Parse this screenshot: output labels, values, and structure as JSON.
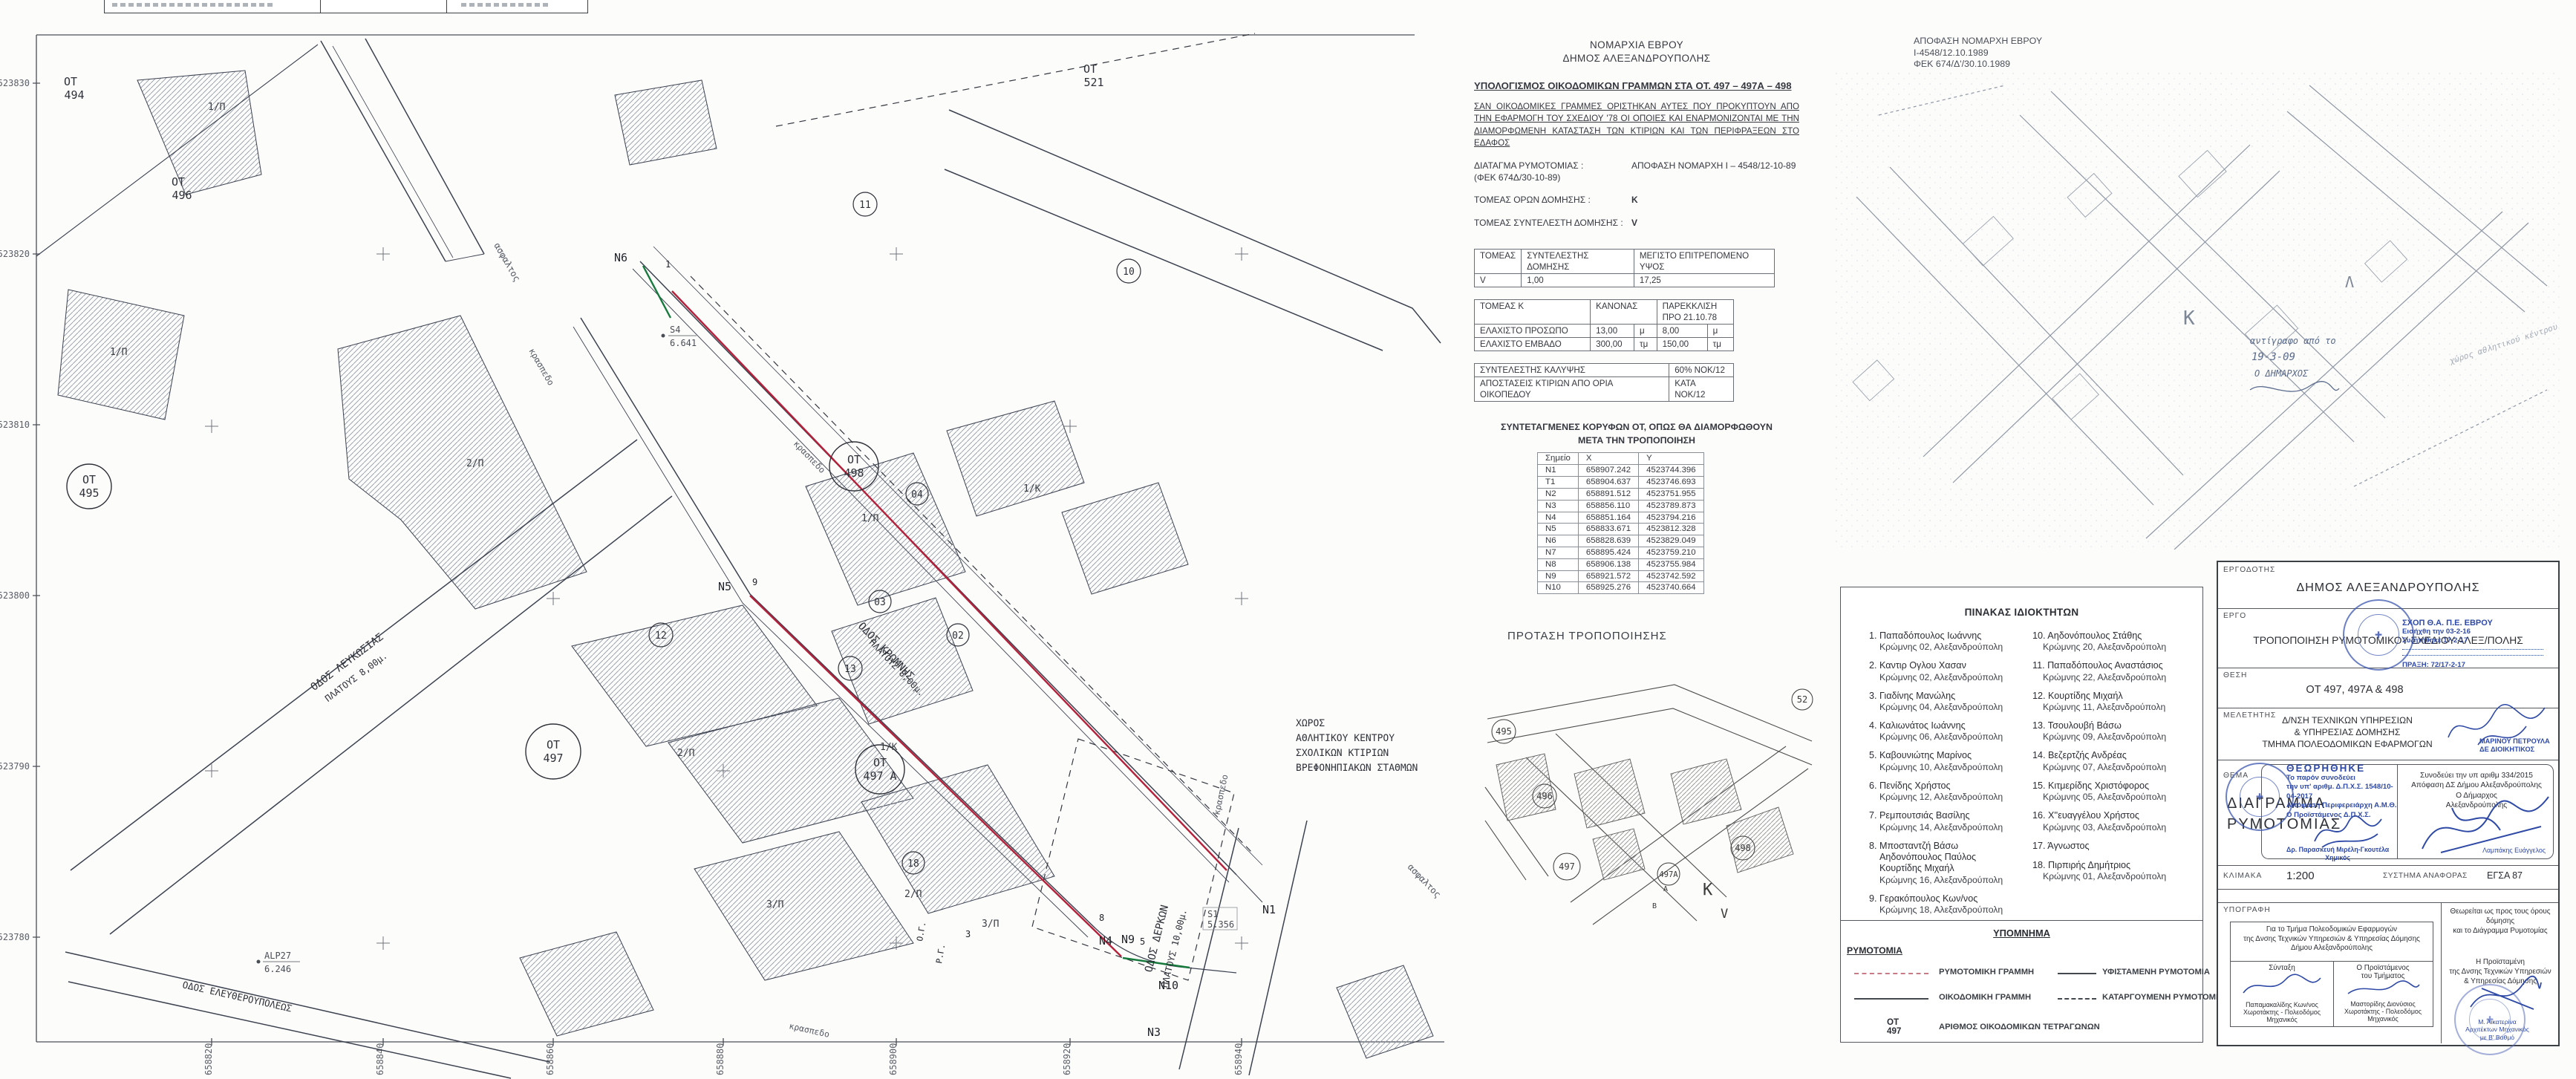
{
  "calc": {
    "org1": "ΝΟΜΑΡΧΙΑ ΕΒΡΟΥ",
    "org2": "ΔΗΜΟΣ ΑΛΕΞΑΝΔΡΟΥΠΟΛΗΣ",
    "title": "ΥΠΟΛΟΓΙΣΜΟΣ ΟΙΚΟΔΟΜΙΚΩΝ ΓΡΑΜΜΩΝ ΣΤΑ ΟΤ. 497 – 497Α – 498",
    "para": "ΣΑΝ ΟΙΚΟΔΟΜΙΚΕΣ ΓΡΑΜΜΕΣ ΟΡΙΣΤΗΚΑΝ ΑΥΤΕΣ ΠΟΥ ΠΡΟΚΥΠΤΟΥΝ ΑΠΟ ΤΗΝ ΕΦΑΡΜΟΓΗ ΤΟΥ ΣΧΕΔΙΟΥ '78 ΟΙ ΟΠΟΙΕΣ ΚΑΙ ΕΝΑΡΜΟΝΙΖΟΝΤΑΙ ΜΕ ΤΗΝ ΔΙΑΜΟΡΦΩΜΕΝΗ ΚΑΤΑΣΤΑΣΗ ΤΩΝ ΚΤΙΡΙΩΝ ΚΑΙ ΤΩΝ ΠΕΡΙΦΡΑΞΕΩΝ ΣΤΟ ΕΔΑΦΟΣ",
    "decree_label": "ΔΙΑΤΑΓΜΑ ΡΥΜΟΤΟΜΙΑΣ :",
    "decree_value": "ΑΠΟΦΑΣΗ ΝΟΜΑΡΧΗ Ι – 4548/12-10-89 (ΦΕΚ 674Δ/30-10-89)",
    "sector_label": "ΤΟΜΕΑΣ ΟΡΩΝ ΔΟΜΗΣΗΣ :",
    "sector_value": "Κ",
    "ratio_label": "ΤΟΜΕΑΣ ΣΥΝΤΕΛΕΣΤΗ ΔΟΜΗΣΗΣ :",
    "ratio_value": "V",
    "t1": {
      "h1": "ΤΟΜΕΑΣ",
      "h2": "ΣΥΝΤΕΛΕΣΤΗΣ ΔΟΜΗΣΗΣ",
      "h3": "ΜΕΓΙΣΤΟ ΕΠΙΤΡΕΠΟΜΕΝΟ ΥΨΟΣ",
      "r1": "V",
      "r2": "1,00",
      "r3": "17,25"
    },
    "t2": {
      "corner": "ΤΟΜΕΑΣ  Κ",
      "h1": "ΚΑΝΟΝΑΣ",
      "h2": "ΠΑΡΕΚΚΛΙΣΗ",
      "h2b": "ΠΡΟ 21.10.78",
      "ra": "ΕΛΑΧΙΣΤΟ ΠΡΟΣΩΠΟ",
      "ra1": "13,00",
      "ra1u": "μ",
      "ra2": "8,00",
      "ra2u": "μ",
      "rb": "ΕΛΑΧΙΣΤΟ ΕΜΒΑΔΟ",
      "rb1": "300,00",
      "rb1u": "τμ",
      "rb2": "150,00",
      "rb2u": "τμ"
    },
    "t3": {
      "ra": "ΣΥΝΤΕΛΕΣΤΗΣ ΚΑΛΥΨΗΣ",
      "rav": "60% ΝΟΚ/12",
      "rb": "ΑΠΟΣΤΑΣΕΙΣ ΚΤΙΡΙΩΝ ΑΠΟ ΟΡΙΑ ΟΙΚΟΠΕΔΟΥ",
      "rbv": "ΚΑΤΑ ΝΟΚ/12"
    },
    "coords_h1": "ΣΥΝΤΕΤΑΓΜΕΝΕΣ ΚΟΡΥΦΩΝ ΟΤ, ΟΠΩΣ ΘΑ ΔΙΑΜΟΡΦΩΘΟΥΝ",
    "coords_h2": "ΜΕΤΑ ΤΗΝ ΤΡΟΠΟΠΟΙΗΣΗ",
    "coords": {
      "headers": [
        "Σημείο",
        "X",
        "Y"
      ],
      "rows": [
        [
          "N1",
          "658907.242",
          "4523744.396"
        ],
        [
          "T1",
          "658904.637",
          "4523746.693"
        ],
        [
          "N2",
          "658891.512",
          "4523751.955"
        ],
        [
          "N3",
          "658856.110",
          "4523789.873"
        ],
        [
          "N4",
          "658851.164",
          "4523794.216"
        ],
        [
          "N5",
          "658833.671",
          "4523812.328"
        ],
        [
          "N6",
          "658828.639",
          "4523829.049"
        ],
        [
          "N7",
          "658895.424",
          "4523759.210"
        ],
        [
          "N8",
          "658906.138",
          "4523755.984"
        ],
        [
          "N9",
          "658921.572",
          "4523742.592"
        ],
        [
          "N10",
          "658925.276",
          "4523740.664"
        ]
      ]
    }
  },
  "proposal": {
    "title": "ΠΡΟΤΑΣΗ ΤΡΟΠΟΠΟΙΗΣΗΣ",
    "b495": "495",
    "b496": "496",
    "b497": "497",
    "b497a": "497Α",
    "b498": "498",
    "b52": "52",
    "k": "Κ",
    "v": "V",
    "a": "Α",
    "b": "Β"
  },
  "fek": {
    "line1": "ΑΠΟΦΑΣΗ ΝΟΜΑΡΧΗ ΕΒΡΟΥ",
    "line2": "Ι-4548/12.10.1989",
    "line3": "ΦΕΚ 674/Δ'/30.10.1989",
    "hand1": "αντίγραφο από το",
    "hand2": "19-3-09",
    "hand3": "Ο ΔΗΜΑΡΧΟΣ",
    "k": "Κ",
    "l": "Λ",
    "note": "χώρος αθλητικού κέντρου"
  },
  "owners": {
    "title": "ΠΙΝΑΚΑΣ ΙΔΙΟΚΤΗΤΩΝ",
    "left": [
      {
        "num": "1.",
        "lines": [
          "Παπαδόπουλος Ιωάννης"
        ],
        "addr": "Κρώμνης 02, Αλεξανδρούπολη"
      },
      {
        "num": "2.",
        "lines": [
          "Καντιρ Ογλου Χασαν"
        ],
        "addr": "Κρώμνης 02, Αλεξανδρούπολη"
      },
      {
        "num": "3.",
        "lines": [
          "Γιαδίνης Μανώλης"
        ],
        "addr": "Κρώμνης 04, Αλεξανδρούπολη"
      },
      {
        "num": "4.",
        "lines": [
          "Καλιωνάτος Ιωάννης"
        ],
        "addr": "Κρώμνης 06, Αλεξανδρούπολη"
      },
      {
        "num": "5.",
        "lines": [
          "Καβουνιώτης Μαρίνος"
        ],
        "addr": "Κρώμνης 10, Αλεξανδρούπολη"
      },
      {
        "num": "6.",
        "lines": [
          "Πενίδης Χρήστος"
        ],
        "addr": "Κρώμνης 12, Αλεξανδρούπολη"
      },
      {
        "num": "7.",
        "lines": [
          "Ρεμπουτσιάς Βασίλης"
        ],
        "addr": "Κρώμνης 14, Αλεξανδρούπολη"
      },
      {
        "num": "8.",
        "lines": [
          "Μποσταντζή Βάσω",
          "Αηδονόπουλος Παύλος",
          "Κουρτίδης Μιχαήλ"
        ],
        "addr": "Κρώμνης 16, Αλεξανδρούπολη"
      },
      {
        "num": "9.",
        "lines": [
          "Γερακόπουλος Κων/νος"
        ],
        "addr": "Κρώμνης 18, Αλεξανδρούπολη"
      }
    ],
    "right": [
      {
        "num": "10.",
        "lines": [
          "Αηδονόπουλος Στάθης"
        ],
        "addr": "Κρώμνης 20, Αλεξανδρούπολη"
      },
      {
        "num": "11.",
        "lines": [
          "Παπαδόπουλος Αναστάσιος"
        ],
        "addr": "Κρώμνης 22, Αλεξανδρούπολη"
      },
      {
        "num": "12.",
        "lines": [
          "Κουρτίδης Μιχαήλ"
        ],
        "addr": "Κρώμνης 11, Αλεξανδρούπολη"
      },
      {
        "num": "13.",
        "lines": [
          "Τσουλουβή Βάσω"
        ],
        "addr": "Κρώμνης 09, Αλεξανδρούπολη"
      },
      {
        "num": "14.",
        "lines": [
          "Βεζερτζής Ανδρέας"
        ],
        "addr": "Κρώμνης 07, Αλεξανδρούπολη"
      },
      {
        "num": "15.",
        "lines": [
          "Κιτμερίδης Χριστόφορος"
        ],
        "addr": "Κρώμνης 05, Αλεξανδρούπολη"
      },
      {
        "num": "16.",
        "lines": [
          "Χ''ευαγγέλου Χρήστος"
        ],
        "addr": "Κρώμνης 03, Αλεξανδρούπολη"
      },
      {
        "num": "17.",
        "lines": [
          "Άγνωστος"
        ],
        "addr": ""
      },
      {
        "num": "18.",
        "lines": [
          "Πιρπιρής Δημήτριος"
        ],
        "addr": "Κρώμνης 01, Αλεξανδρούπολη"
      }
    ]
  },
  "legend": {
    "title": "ΥΠΟΜΝΗΜΑ",
    "group": "ΡΥΜΟΤΟΜΙΑ",
    "i1": "ΡΥΜΟΤΟΜΙΚΗ ΓΡΑΜΜΗ",
    "i2": "ΥΦΙΣΤΑΜΕΝΗ ΡΥΜΟΤΟΜΙΑ",
    "i3": "ΟΙΚΟΔΟΜΙΚΗ ΓΡΑΜΜΗ",
    "i4": "ΚΑΤΑΡΓΟΥΜΕΝΗ ΡΥΜΟΤΟΜΙΑ",
    "ot": "ΟΤ",
    "ot_num": "497",
    "ot_desc": "ΑΡΙΘΜΟΣ ΟΙΚΟΔΟΜΙΚΩΝ ΤΕΤΡΑΓΩΝΩΝ"
  },
  "titleblock": {
    "employer_label": "ΕΡΓΟΔΟΤΗΣ",
    "employer": "ΔΗΜΟΣ  ΑΛΕΞΑΝΔΡΟΥΠΟΛΗΣ",
    "project_label": "ΕΡΓΟ",
    "project": "ΤΡΟΠΟΠΟΙΗΣΗ ΡΥΜΟΤΟΜΙΚΟΥ ΣΧΕΔΙΟΥ ΑΛΕΞ/ΠΟΛΗΣ",
    "location_label": "ΘΕΣΗ",
    "location": "ΟΤ 497, 497Α & 498",
    "designer_label": "ΜΕΛΕΤΗΤΗΣ",
    "designer1": "Δ/ΝΣΗ ΤΕΧΝΙΚΩΝ ΥΠΗΡΕΣΙΩΝ",
    "designer2": "& ΥΠΗΡΕΣΙΑΣ ΔΟΜΗΣΗΣ",
    "designer3": "ΤΜΗΜΑ ΠΟΛΕΟΔΟΜΙΚΩΝ ΕΦΑΡΜΟΓΩΝ",
    "clerk1": "ΜΑΡΙΝΟΥ ΠΕΤΡΟΥΛΑ",
    "clerk2": "ΔΕ ΔΙΟΙΚΗΤΙΚΟΣ",
    "theme_label": "ΘΕΜΑ",
    "theme1": "ΔΙΑΓΡΑΜΜΑ",
    "theme2": "ΡΥΜΟΤΟΜΙΑΣ",
    "stamp_sxop1": "ΣΧΟΠ Θ.Α. Π.Ε. ΕΒΡΟΥ",
    "stamp_sxop2": "Εισήχθη την  03-2-16",
    "stamp_sxop3": "Συζητήθηκε  17-2-17",
    "stamp_sxop4": "ΠΡΑΞΗ: 72/17-2-17",
    "stamp_th1": "ΘΕΩΡΗΘΗΚΕ",
    "stamp_th2": "Το παρόν συνοδεύει",
    "stamp_th3": "την υπ' αριθμ. Δ.Π.Χ.Σ. 1548/10-04-2017",
    "stamp_th4": "Απόφαση Περιφερειάρχη Α.Μ.Θ.",
    "stamp_th5": "Ο Προϊστάμενος Δ.Π.Χ.Σ.",
    "stamp_th_name": "Δρ. Παρασκευή Μιρέλη-Γκουτέλα",
    "stamp_th_role": "Χημικός",
    "mayor1": "Συνοδεύει την υπ αριθμ 334/2015",
    "mayor2": "Απόφαση ΔΣ Δήμου Αλεξανδρούπολης",
    "mayor3": "Ο Δήμαρχος",
    "mayor4": "Αλεξανδρούπολης",
    "mayor_name": "Λαμπάκης Ευάγγελος",
    "scale_label": "ΚΛΙΜΑΚΑ",
    "scale": "1:200",
    "ref_label": "ΣΥΣΤΗΜΑ ΑΝΑΦΟΡΑΣ",
    "ref": "ΕΓΣΑ 87",
    "sig_label": "ΥΠΟΓΡΑΦΗ",
    "sig_head1": "Για το Τμήμα Πολεοδομικών Εφαρμογών",
    "sig_head2": "της Δνσης Τεχνικών Υπηρεσιών & Υπηρεσίας Δόμησης",
    "sig_head3": "Δήμου Αλεξανδρούπολης",
    "sig_c1_title": "Σύνταξη",
    "sig_c1_name": "Παπαμακαλίδης Κων/νος",
    "sig_c1_role": "Χωροτάκτης - Πολεοδόμος Μηχανικός",
    "sig_c2_title": "Ο Προϊστάμενος",
    "sig_c2_title2": "του Τμήματος",
    "sig_c2_name": "Μαστορίδης Διονύσιος",
    "sig_c2_role": "Χωροτάκτης - Πολεοδόμος Μηχανικός",
    "right_h1": "Θεωρείται ως προς τους όρους δόμησης",
    "right_h2": "και το Διάγραμμα Ρυμοτομίας",
    "right_p1": "Η Προϊσταμένη",
    "right_p2": "της Δνσης Τεχνικών Υπηρεσιών",
    "right_p3": "& Υπηρεσίας Δόμησης",
    "right_name": "Μ. Αικατερίνα",
    "right_role1": "Αρχιτέκτων Μηχανικός",
    "right_role2": "με Β' Βαθμό"
  },
  "map": {
    "x_ticks": [
      "658820",
      "658840",
      "658860",
      "658880",
      "658900",
      "658920",
      "658940"
    ],
    "y_ticks": [
      "4523830",
      "4523820",
      "4523810",
      "4523800",
      "4523790",
      "4523780"
    ],
    "streets": {
      "kromnis1": "ΟΔΟΣ ΚΡΩΜΝΗΣ",
      "kromnis2": "ΠΛΑΤΟΥΣ 8,00μ.",
      "lefkosias1": "ΟΔΟΣ ΛΕΥΚΩΣΙΑΣ",
      "lefkosias2": "ΠΛΑΤΟΥΣ 8,00μ.",
      "derkon1": "ΟΔΟΣ ΔΕΡΚΩΝ",
      "derkon2": "ΠΛΑΤΟΥΣ 10,00μ.",
      "eleftheroupoleos": "ΟΔΟΣ ΕΛΕΥΘΕΡΟΥΠΟΛΕΩΣ",
      "asphalt": "ασφαλτος",
      "curb": "κρασπεδο"
    },
    "ot_prefix": "ΟΤ",
    "ot": {
      "n494": "494",
      "n495": "495",
      "n496": "496",
      "n497": "497",
      "n497a": "497 Α",
      "n498": "498",
      "n521": "521"
    },
    "points": {
      "n1": "N1",
      "n3": "N3",
      "n4": "N4",
      "n5": "N5",
      "n6": "N6",
      "n9": "N9",
      "n10": "N10"
    },
    "vertices": {
      "v1": "1",
      "v3": "3",
      "v5": "5",
      "v8": "8",
      "v9": "9"
    },
    "misc": {
      "og": "Ο.Γ.",
      "rg": "Ρ.Γ."
    },
    "benchmarks": {
      "s4": "S4",
      "s4v": "6.641",
      "alp": "ALP27",
      "alpv": "6.246",
      "s1": "S1",
      "s1v": "5.356"
    },
    "parcels": {
      "p1": "2/Π",
      "p2": "1/Κ",
      "p3": "1/Π",
      "p4": "1/Π",
      "p5": "1/Κ",
      "p6": "2/Π",
      "p7": "3/Π",
      "p8": "3/Π",
      "p9": "2/Π",
      "p10": "1/Π"
    },
    "circles": {
      "c10": "10",
      "c11": "11",
      "c12": "12",
      "c13": "13",
      "c02": "02",
      "c03": "03",
      "c04": "04",
      "c18": "18"
    },
    "area_note": [
      "ΧΩΡΟΣ",
      "ΑΘΛΗΤΙΚΟΥ ΚΕΝΤΡΟΥ",
      "ΣΧΟΛΙΚΩΝ ΚΤΙΡΙΩΝ",
      "ΒΡΕΦΟΝΗΠΙΑΚΩΝ ΣΤΑΘΜΩΝ"
    ]
  },
  "colors": {
    "redline": "#b5203a",
    "greenline": "#177a3d",
    "stampblue": "#2e49a6",
    "ink": "#3c4250"
  }
}
